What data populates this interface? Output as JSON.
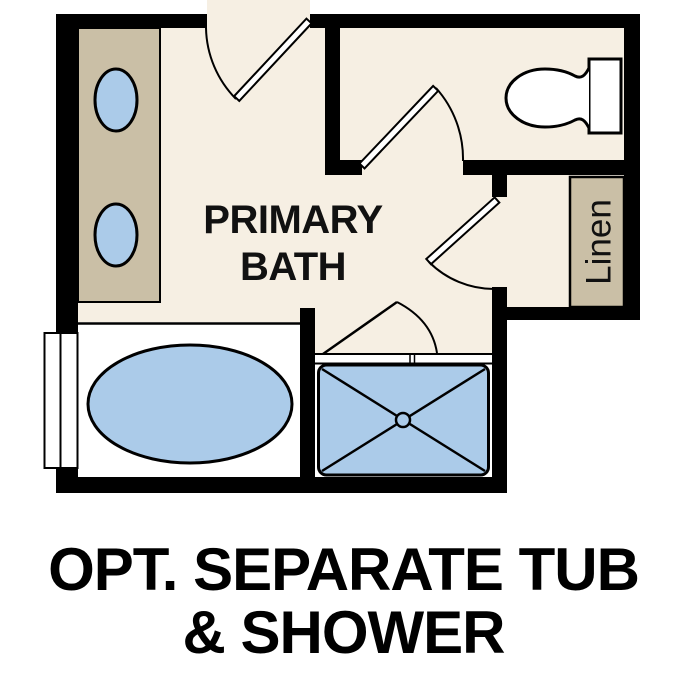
{
  "labels": {
    "room_line1": "PRIMARY",
    "room_line2": "BATH",
    "linen": "Linen",
    "caption_line1": "OPT. SEPARATE TUB",
    "caption_line2": "& SHOWER"
  },
  "colors": {
    "background": "#ffffff",
    "floor": "#f6efe3",
    "wall": "#000000",
    "cabinet": "#cabfa6",
    "fixture_blue": "#abcbe9",
    "fixture_white": "#ffffff",
    "label_text": "#111111"
  },
  "fixtures": {
    "vanity": "double-sink-vanity",
    "sinks": [
      "oval-sink",
      "oval-sink"
    ],
    "toilet": "toilet",
    "tub": "oval-soaking-tub",
    "shower": "walk-in-shower-with-drain",
    "linen_shelf": "linen-shelf",
    "window": "window",
    "doors": [
      "entry-swing-door",
      "water-closet-swing-door",
      "linen-hall-swing-door",
      "shower-swing-door"
    ]
  }
}
